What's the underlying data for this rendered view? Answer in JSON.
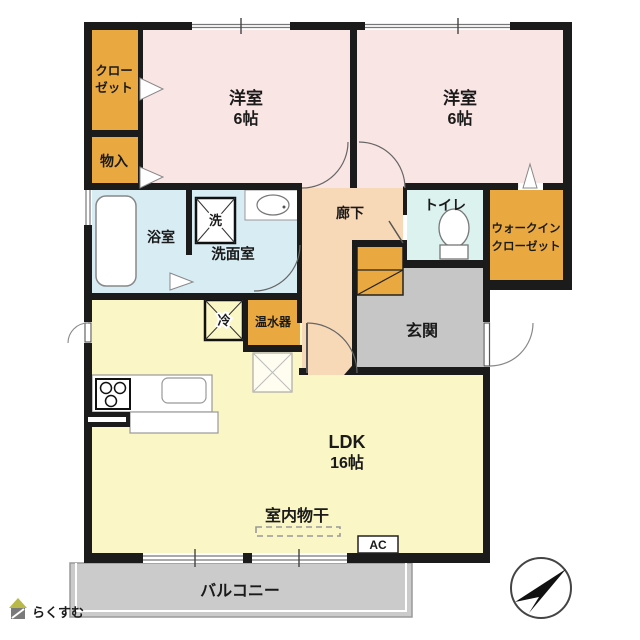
{
  "title": "2LDK apartment floor plan",
  "rooms": {
    "closet": {
      "line1": "クロー",
      "line2": "ゼット"
    },
    "storage": {
      "label": "物入"
    },
    "bedroom1": {
      "label": "洋室",
      "size": "6帖"
    },
    "bedroom2": {
      "label": "洋室",
      "size": "6帖"
    },
    "bath": {
      "label": "浴室"
    },
    "washroom": {
      "label": "洗面室"
    },
    "hallway": {
      "label": "廊下"
    },
    "toilet": {
      "label": "トイレ"
    },
    "wic": {
      "line1": "ウォークイン",
      "line2": "クローゼット"
    },
    "entrance": {
      "label": "玄関"
    },
    "ldk": {
      "label": "LDK",
      "size": "16帖"
    },
    "balcony": {
      "label": "バルコニー"
    }
  },
  "fixtures": {
    "washer_symbol": "洗",
    "fridge_symbol": "冷",
    "water_heater": "温水器",
    "indoor_drying": "室内物干",
    "ac_label": "AC"
  },
  "branding": {
    "logo_text": "らくすむ"
  },
  "colors": {
    "wall": "#1b1b1b",
    "bedroom_pink": "#f9e5e3",
    "closet_orange": "#e9a940",
    "bath_cyan": "#d7ecf3",
    "toilet_cyan": "#dcf2ef",
    "hallway_peach": "#f7d8b7",
    "entrance_gray": "#c6c6c6",
    "ldk_yellow": "#faf6c5",
    "balcony_gray": "#cbcbcb"
  }
}
